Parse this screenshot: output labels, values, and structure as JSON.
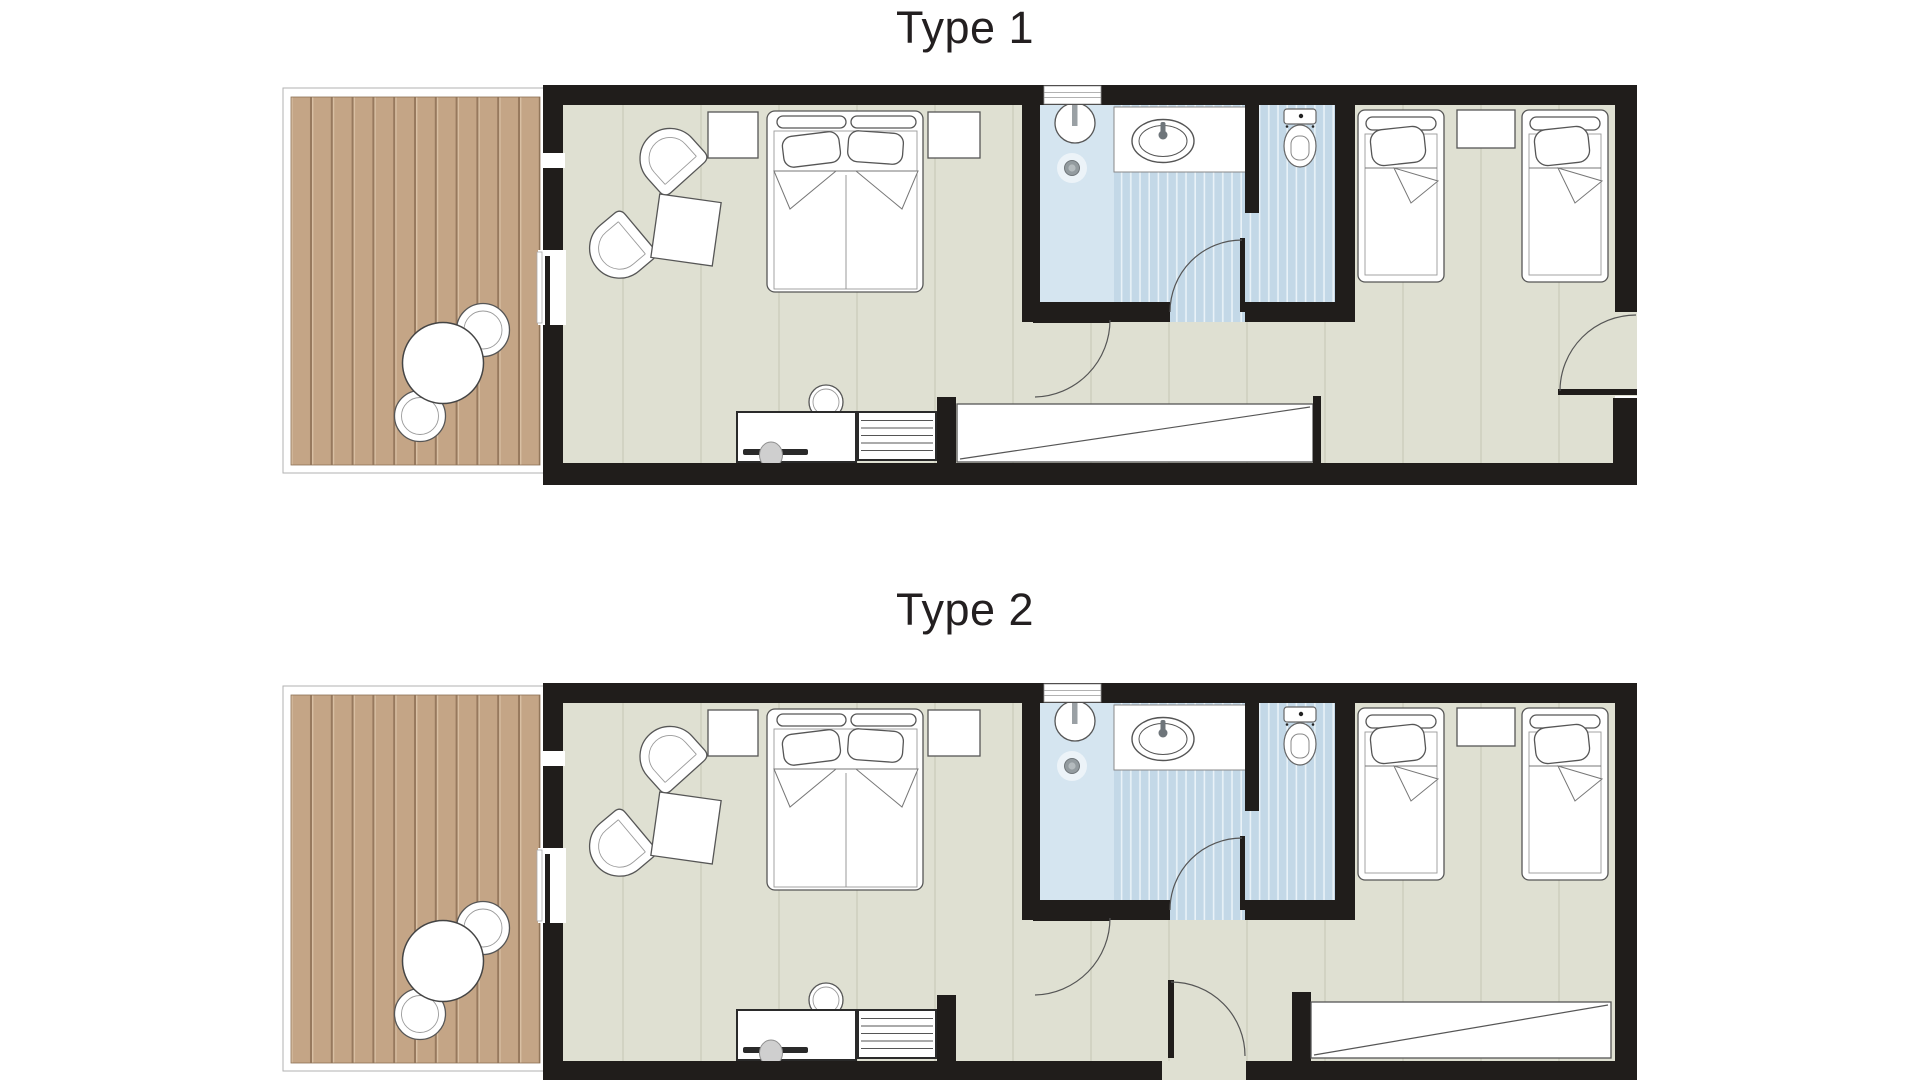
{
  "sheet": {
    "kind": "hotel room floor plans",
    "background": "#ffffff"
  },
  "plans": [
    {
      "id": "type-1",
      "title": "Type 1",
      "entry": "door in right (east) wall near bottom corner",
      "wardrobe": "long wardrobe in bottom hallway, left of entry corridor",
      "rooms": [
        "terrace deck",
        "double bedroom with seating",
        "bathroom",
        "wc",
        "twin bedroom",
        "hallway"
      ]
    },
    {
      "id": "type-2",
      "title": "Type 2",
      "entry": "door in bottom (south) wall of hallway",
      "wardrobe": "wardrobe on right side of hallway below twin bedroom",
      "rooms": [
        "terrace deck",
        "double bedroom with seating",
        "bathroom",
        "wc",
        "twin bedroom",
        "hallway"
      ]
    }
  ],
  "furniture_icons": [
    "outdoor-table-icon",
    "outdoor-chair-icon",
    "armchair-icon",
    "coffee-table-icon",
    "nightstand-icon",
    "double-bed-icon",
    "twin-bed-icon",
    "desk-icon",
    "desk-chair-icon",
    "stool-icon",
    "shelf-unit-icon",
    "wardrobe-icon",
    "shower-head-icon",
    "floor-drain-icon",
    "vanity-sink-icon",
    "toilet-icon",
    "door-swing-icon",
    "sliding-door-icon",
    "window-icon"
  ],
  "colors": {
    "wall": "#201d1b",
    "floor": "#dfe0d2",
    "floor-line": "#d2d3c3",
    "deck": "#c4a586",
    "deck-groove": "#97795e",
    "bath-plain": "#d5e5f0",
    "bath-tile": "#c3d8e7",
    "bath-tile-line": "#e9f2f8",
    "title-text": "#231f20"
  }
}
